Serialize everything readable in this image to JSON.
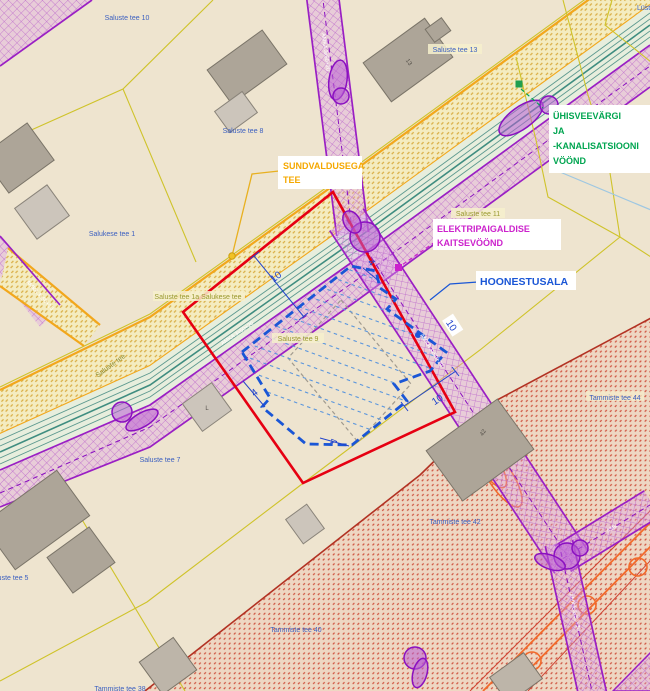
{
  "map_type": "detail-plan-map",
  "colors": {
    "background": "#eee4cf",
    "red_boundary": "#e60012",
    "hoonestusala_blue": "#1a56d6",
    "electric_magenta": "#cc22cc",
    "water_green": "#00a550",
    "sundvaldus_orange": "#f5a800",
    "zone_purple": "#9a1fc4",
    "parcel_yellow": "#cfc32a",
    "tammiste_red": "#cf5340"
  },
  "parcels": [
    "Saluste tee 10",
    "Saluste tee 8",
    "Saluste tee 13",
    "Saluste tee 11",
    "Salukese tee 1",
    "Saluste tee 1a Salukese tee",
    "Saluste tee 9",
    "Saluste tee 7",
    "Saluste tee 5",
    "Saluste tee 3",
    "Tammiste tee 44",
    "Tammiste tee 42",
    "Tammiste tee 40",
    "Tammiste tee 38",
    "Lüst"
  ],
  "annotations": {
    "water": {
      "lines": [
        "ÜHISVEEVÄRGI",
        "JA",
        "-KANALISATSIOONI",
        "VÖÖND"
      ]
    },
    "road": {
      "lines": [
        "SUNDVALDUSEGA",
        "TEE"
      ]
    },
    "electric": {
      "lines": [
        "ELEKTRIPAIGALDISE",
        "KAITSEVÖÖND"
      ]
    },
    "building": {
      "lines": [
        "HOONESTUSALA"
      ]
    }
  },
  "dimensions": {
    "d1": "10",
    "d2": "4",
    "d3": "10",
    "d4": "10",
    "d5": "4",
    "d6": "4"
  },
  "cables": {
    "main": "AMKA 3x50+20",
    "branch": "AMKA 3x50+20",
    "p2": "AMKA 3x50+20",
    "p3": "AMKA 3x50+20",
    "p4": "AMK",
    "p5": "AMKA 3x50+70"
  },
  "road_labels": {
    "main": "Saluste tee"
  },
  "building_marks": {
    "b3": "13",
    "b9": "42",
    "b6": "L"
  }
}
